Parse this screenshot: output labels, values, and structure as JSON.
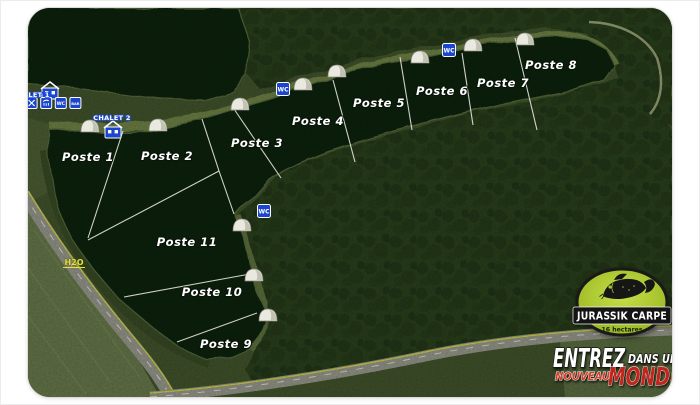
{
  "colors": {
    "water": "#0c2411",
    "land": "#41532b",
    "forest": "#2b3f1e",
    "bank": "#6d8045",
    "road": "#96978a",
    "icon_blue": "#1b45cc",
    "logo_green": "#a6c62e",
    "accent_red": "#c3241c",
    "divider_white": "#f1f1e8",
    "water_label_yellow": "#e6e432"
  },
  "map": {
    "postes": [
      {
        "label": "Poste 1",
        "x": 88,
        "y": 161
      },
      {
        "label": "Poste 2",
        "x": 167,
        "y": 160
      },
      {
        "label": "Poste 3",
        "x": 257,
        "y": 147
      },
      {
        "label": "Poste 4",
        "x": 318,
        "y": 125
      },
      {
        "label": "Poste 5",
        "x": 379,
        "y": 107
      },
      {
        "label": "Poste 6",
        "x": 442,
        "y": 95
      },
      {
        "label": "Poste 7",
        "x": 503,
        "y": 87
      },
      {
        "label": "Poste 8",
        "x": 551,
        "y": 69
      },
      {
        "label": "Poste 9",
        "x": 226,
        "y": 348
      },
      {
        "label": "Poste 10",
        "x": 212,
        "y": 296
      },
      {
        "label": "Poste 11",
        "x": 187,
        "y": 246
      }
    ],
    "chalets": [
      {
        "label": "CHALET 1",
        "label_x": 31,
        "label_y": 97,
        "icon_x": 50,
        "icon_y": 93
      },
      {
        "label": "CHALET 2",
        "label_x": 112,
        "label_y": 120,
        "icon_x": 113,
        "icon_y": 132
      }
    ],
    "amenities": {
      "x": 17,
      "y": 103,
      "items": [
        {
          "name": "power-icon",
          "type": "power"
        },
        {
          "name": "cutlery-icon",
          "type": "cutlery"
        },
        {
          "name": "shower-icon",
          "type": "shower"
        },
        {
          "name": "wc-icon",
          "type": "text",
          "text": "WC",
          "size": 4.6
        },
        {
          "name": "bar-icon",
          "type": "text",
          "text": "BAR",
          "size": 3.6
        }
      ]
    },
    "wc_points": [
      {
        "x": 449,
        "y": 50,
        "label": "WC"
      },
      {
        "x": 283,
        "y": 89,
        "label": "WC"
      },
      {
        "x": 264,
        "y": 211,
        "label": "WC"
      }
    ],
    "water_point": {
      "text": "H2O",
      "x": 74,
      "y": 265
    },
    "tents": [
      [
        90,
        127
      ],
      [
        158,
        126
      ],
      [
        240,
        105
      ],
      [
        303,
        85
      ],
      [
        337,
        72
      ],
      [
        420,
        58
      ],
      [
        473,
        46
      ],
      [
        525,
        40
      ],
      [
        242,
        226
      ],
      [
        254,
        276
      ],
      [
        268,
        316
      ]
    ],
    "divider_lines": [
      [
        123,
        131,
        88,
        238
      ],
      [
        202,
        119,
        219,
        171
      ],
      [
        219,
        171,
        88,
        240
      ],
      [
        219,
        171,
        234,
        214
      ],
      [
        234,
        109,
        281,
        178
      ],
      [
        333,
        80,
        355,
        162
      ],
      [
        400,
        57,
        412,
        130
      ],
      [
        462,
        53,
        473,
        125
      ],
      [
        515,
        38,
        537,
        130
      ],
      [
        124,
        297,
        250,
        274
      ],
      [
        177,
        342,
        257,
        313
      ]
    ]
  },
  "logo": {
    "name": "JURASSIK CARPE",
    "area": "16 hectares"
  },
  "tagline": {
    "word1": "ENTREZ",
    "word2": "DANS UN",
    "word3": "NOUVEAU",
    "word4": "MONDE"
  }
}
